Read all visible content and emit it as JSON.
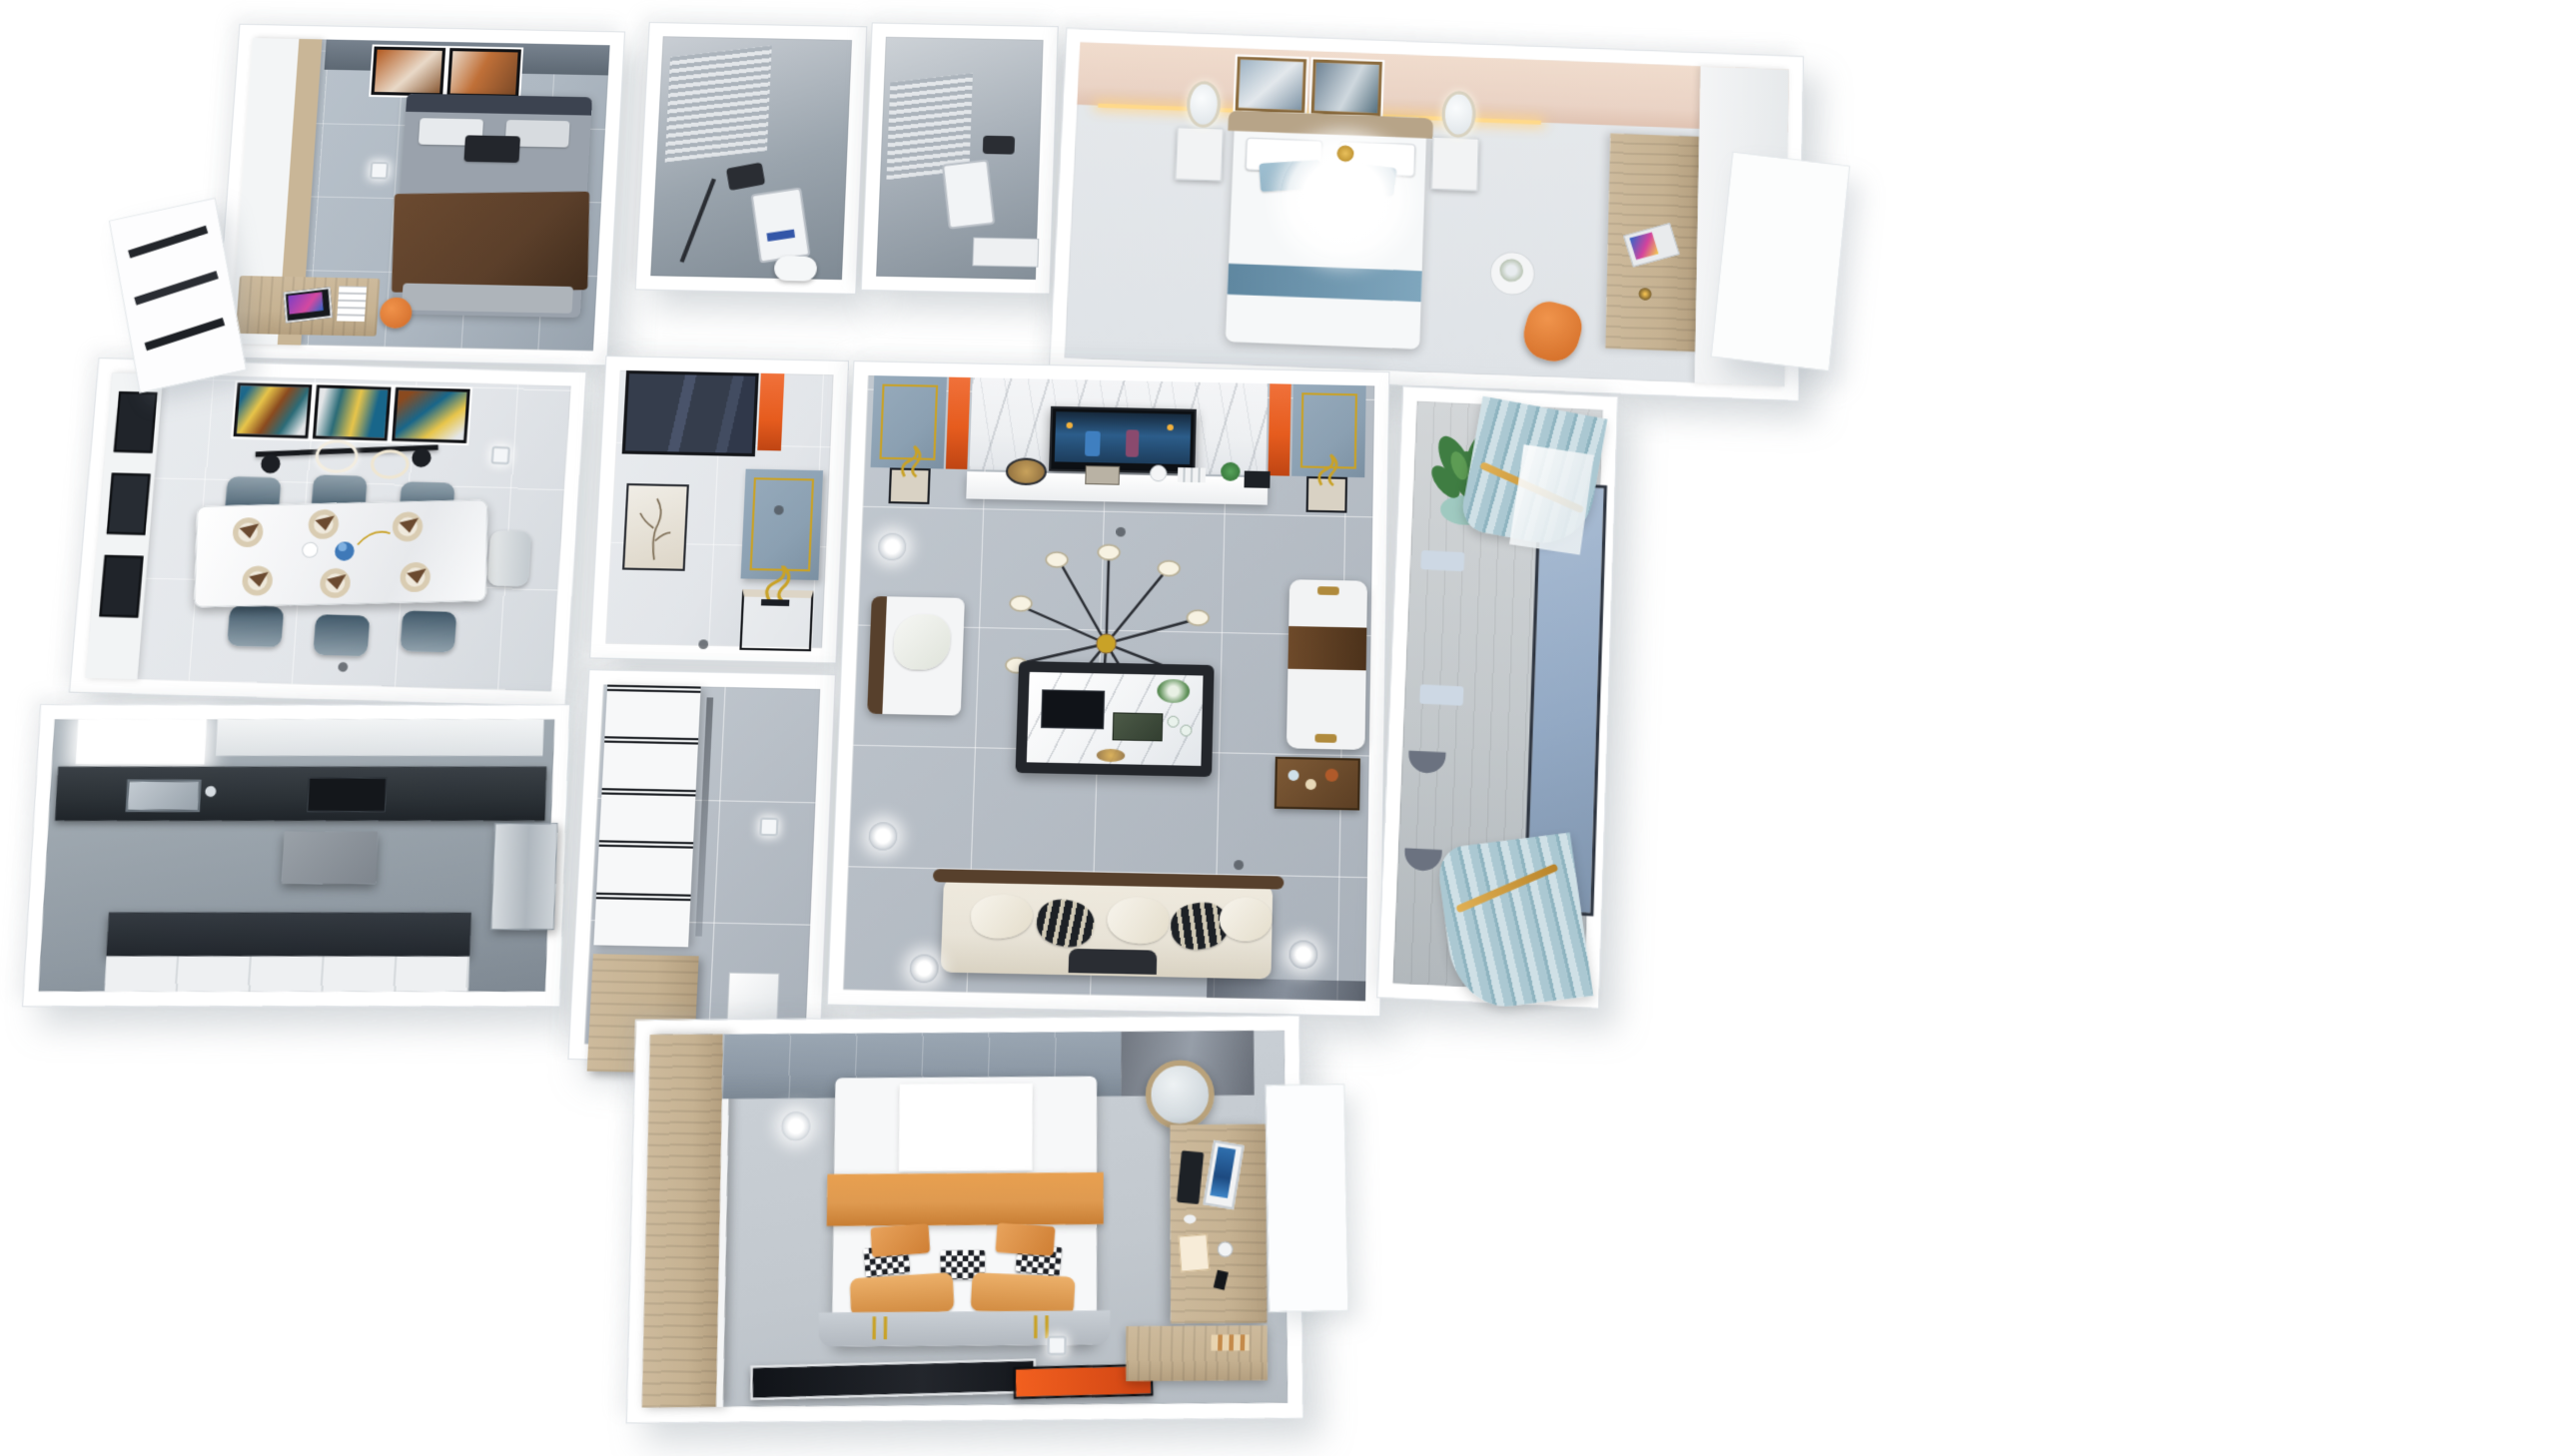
{
  "scene": {
    "type": "3d-dollhouse-floorplan-render",
    "style": "modern-apartment-interior",
    "background": "#ffffff",
    "view": "top-down-perspective-cutaway",
    "rooms": [
      {
        "id": "secondary-bedroom",
        "position": "top-left",
        "features": [
          "white-wood-wardrobe",
          "desk-with-monitor",
          "orange-desk-chair",
          "gray-bed-with-brown-blanket",
          "orange-abstract-art-frames",
          "gray-accent-wall"
        ]
      },
      {
        "id": "bathroom-one",
        "position": "top-center-left",
        "features": [
          "gray-tile-walls",
          "glass-shower",
          "black-shower-fixture",
          "white-control-panel",
          "window-blinds",
          "toilet"
        ]
      },
      {
        "id": "bathroom-two",
        "position": "top-center",
        "features": [
          "gray-tile-walls",
          "shower-panel",
          "white-vanity",
          "window-blinds"
        ]
      },
      {
        "id": "guest-bedroom",
        "position": "top-right",
        "features": [
          "blush-headboard-wall",
          "two-art-frames",
          "white-feather-chandelier",
          "white-bed-blue-pillows",
          "two-nightstands-oval-mirrors",
          "orange-accent-chair",
          "wood-desk-with-laptop",
          "flower-side-table"
        ]
      },
      {
        "id": "dining-room",
        "position": "middle-left",
        "features": [
          "triptych-abstract-art",
          "black-gold-linear-pendant",
          "white-marble-dining-table",
          "six-place-settings",
          "teal-upholstered-chairs",
          "white-sideboard-black-glass"
        ]
      },
      {
        "id": "kitchen",
        "position": "bottom-left",
        "features": [
          "dark-stone-counters",
          "sink-under-window",
          "range-hood",
          "white-cabinets",
          "steel-fridge"
        ]
      },
      {
        "id": "foyer",
        "position": "center",
        "features": [
          "navy-glass-entry-door",
          "orange-accent-strip",
          "blue-gray-panel-gold-trim",
          "console-with-gold-sculpture",
          "branch-artwork"
        ]
      },
      {
        "id": "hallway",
        "position": "center-lower",
        "features": [
          "white-cabinets-black-trim",
          "tall-wood-cabinet",
          "marble-floor"
        ]
      },
      {
        "id": "living-room",
        "position": "center-right",
        "features": [
          "marble-tv-wall",
          "orange-accent-strips",
          "blue-gray-panels-gold-trim",
          "wall-tv-playing-video",
          "white-media-console",
          "gold-sculptures",
          "sputnik-chandelier",
          "marble-coffee-table-tea-set",
          "white-armchair",
          "white-chaise-brown-throw",
          "cream-sofa-striped-pillows",
          "gray-marble-floor",
          "ceiling-spotlights"
        ]
      },
      {
        "id": "balcony",
        "position": "right",
        "features": [
          "potted-plant",
          "light-blue-curtains-gold-ties",
          "large-blue-window",
          "wood-plank-floor",
          "two-stools"
        ]
      },
      {
        "id": "master-bedroom",
        "position": "bottom-center",
        "features": [
          "wood-wardrobe-column",
          "gray-tile-accent-wall",
          "white-bed-orange-runner",
          "orange-pillows",
          "checkered-pillows",
          "black-rug-orange-stripe",
          "wood-desk-with-monitor",
          "round-mirror",
          "vanity-counter",
          "window-bay"
        ]
      }
    ],
    "lighting": [
      "recessed-downlights",
      "floor-spot-glows",
      "cove-light-guest-bedroom"
    ]
  },
  "palette": {
    "wall": "#ffffff",
    "wall_edge": "#dfe3e7",
    "floor_gray": "#b7bec6",
    "floor_light": "#e2e5e9",
    "floor_cool": "#aeb8c2",
    "marble_white": "#eef0f2",
    "wood": "#c6b292",
    "wood_dark": "#a8936f",
    "orange": "#e65c1e",
    "orange_soft": "#df9a50",
    "blush": "#ead3c5",
    "navy": "#3a4252",
    "panel_blue": "#8ba0b2",
    "teal_chair": "#41596a",
    "curtain": "#abc8d2",
    "window_blue": "#93a9c4",
    "plant": "#3f7d42",
    "gold": "#c9a227",
    "counter": "#2b3136",
    "screen_blue": "#2f6fae",
    "brown": "#5b3f2a",
    "cream": "#e8e3d7",
    "charcoal": "#1b1e24"
  }
}
